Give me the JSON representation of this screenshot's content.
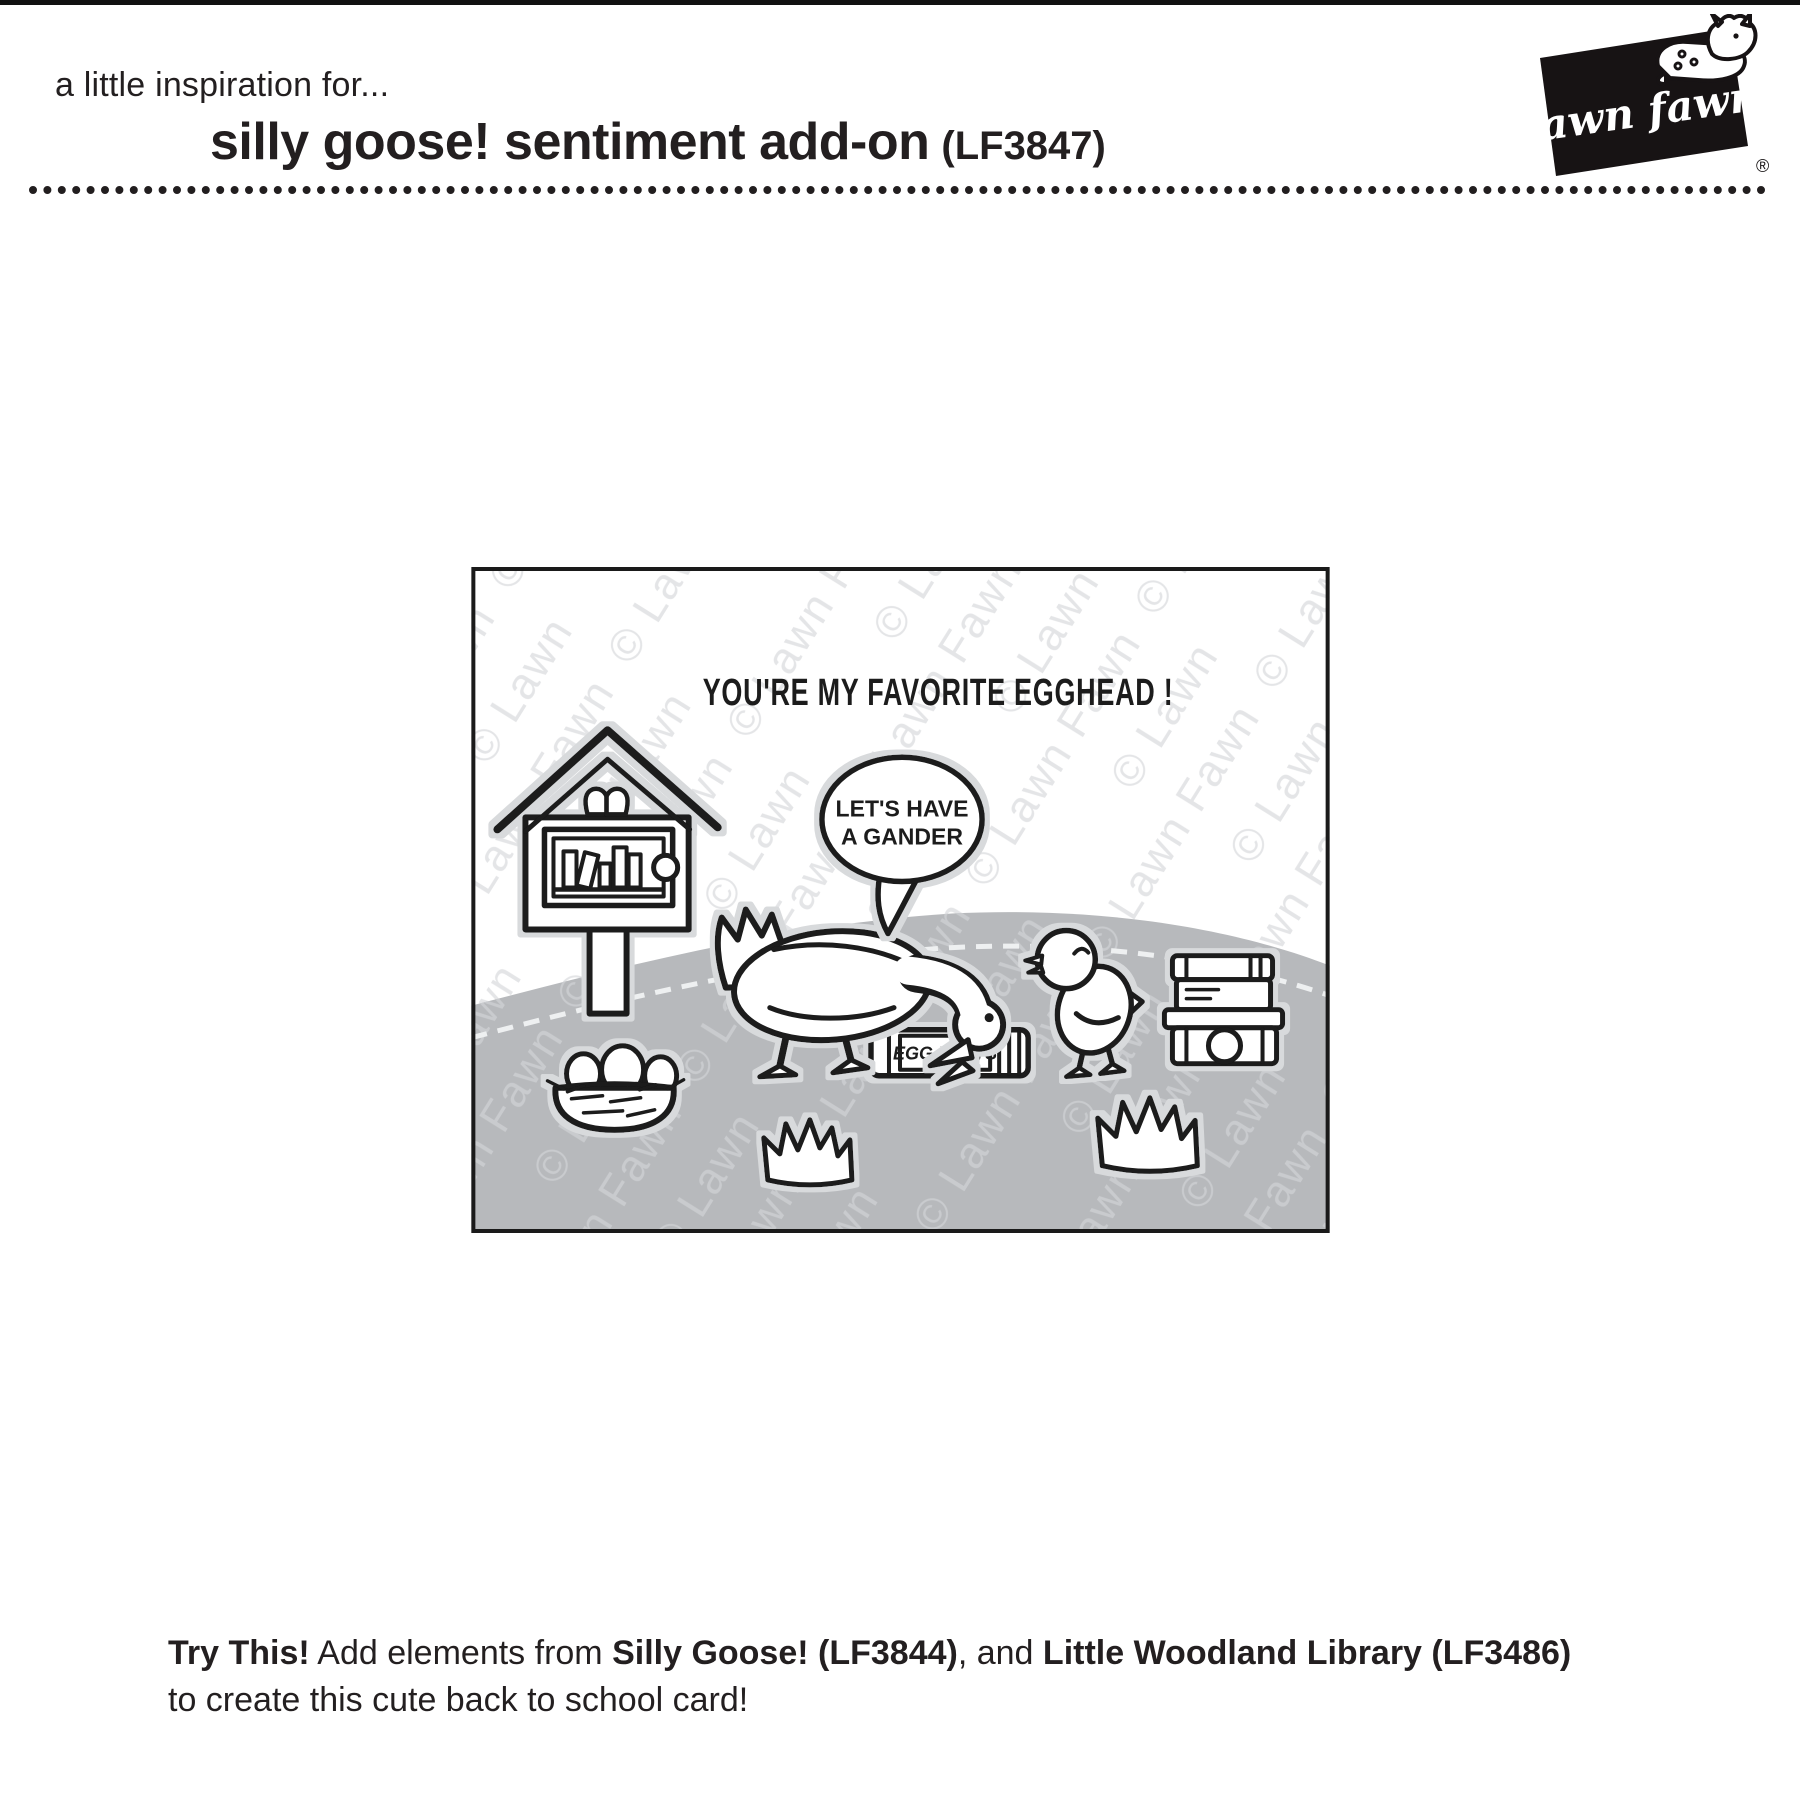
{
  "header": {
    "intro": "a little inspiration for...",
    "title": "silly goose! sentiment add-on",
    "code": "(LF3847)"
  },
  "logo": {
    "text": "lawn fawn",
    "reg": "®",
    "icon": "fawn-deer-icon"
  },
  "card": {
    "sentiment": "YOU'RE MY FAVORITE EGGHEAD !",
    "bubble": {
      "line1": "LET'S HAVE",
      "line2": "A GANDER"
    },
    "book_label": "EGG FACTS",
    "watermark": "© Lawn Fawn",
    "elements": [
      "little-library-on-post",
      "speech-bubble",
      "goose",
      "gosling",
      "nest-with-three-eggs",
      "egg-facts-book",
      "stack-of-books",
      "grass-tuft-center",
      "grass-tuft-right"
    ],
    "colors": {
      "ink": "#1a1a1a",
      "hill": "#b7b9bc",
      "halo": "#d8dadc",
      "dash": "#eef0f1",
      "watermark_on_white": "#e4e5e7",
      "watermark_on_hill": "#c9cbce"
    }
  },
  "footer": {
    "seg1": "Try This!",
    "seg2": " Add elements from ",
    "seg3": "Silly Goose! (LF3844)",
    "seg4": ", and ",
    "seg5": "Little Woodland Library (LF3486)",
    "line2": "to create this cute back to school card!"
  }
}
